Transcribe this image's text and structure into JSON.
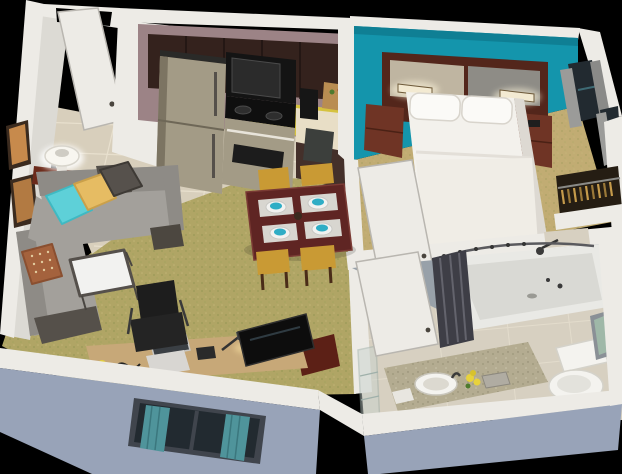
{
  "scene": {
    "title": "3D cutaway floor plan render of a studio hotel suite",
    "view": "aerial isometric cutaway on black background"
  },
  "palette": {
    "black": "#000000",
    "wallWhite": "#edebe6",
    "wallShade": "#c9c6c0",
    "wallFace": "#dcdad4",
    "extWall": "#98a3b8",
    "tile": "#d8cfbc",
    "carpet": "#b0a565",
    "bedroomCarpet": "#c1ac73",
    "bathTile": "#d7d0c1",
    "teal": "#1495ac",
    "mauve": "#9c8386",
    "cabinet": "#34221d",
    "backsplash": "#d5c23f",
    "counter": "#e8dec6",
    "stainless": "#a39b86",
    "applianceBlack": "#141414",
    "headboardWood": "#53261b",
    "headboardTan": "#bfb5a1",
    "headboardGray": "#8e8c86",
    "nightstand": "#6f3425",
    "bedWhite": "#f3f1ec",
    "sofa": "#a3a09b",
    "sofaDark": "#8e8b86",
    "pillowTeal": "#5ed0d8",
    "pillowYellow": "#e6bc63",
    "pillowGray": "#56514c",
    "pillowRust": "#a4623d",
    "consoleWood": "#6b2a1a",
    "tableWood": "#5f2523",
    "chairYellow": "#c99a34",
    "plateWhite": "#f2f2f0",
    "bowlTeal": "#2fadc5",
    "deskWood": "#c7a878",
    "chairBlack": "#1d1d1d",
    "tvBlack": "#0d0d0d",
    "tvStand": "#5c2016",
    "curtainTeal": "#4f949b",
    "glassDark": "#222a30",
    "curtainGray": "#9b9b99",
    "showerWall": "#98a1a9",
    "tubWhite": "#e9e9e5",
    "curtainDark": "#3e3e46",
    "vanityCounter": "#b4ac91",
    "porcelain": "#f4f3ef",
    "glassGreen": "#9fb8a8",
    "hangerGold": "#c59b4b",
    "closetDark": "#251d13",
    "artOrange": "#c78a4c",
    "frameDark": "#3b2b1f",
    "lampWhite": "#f8f6f0"
  },
  "rooms": {
    "entry": {
      "label": "Entry",
      "items": [
        "open entry door",
        "tile floor",
        "closet partition"
      ]
    },
    "kitchen": {
      "label": "Kitchen",
      "items": [
        "stainless refrigerator",
        "microwave",
        "range with oven",
        "dark upper cabinets",
        "yellow backsplash",
        "counter with coffee maker and bread basket",
        "trash can"
      ]
    },
    "dining": {
      "label": "Dining Area",
      "items": [
        "dark wood table",
        "four mustard chairs",
        "four place settings with teal bowls on gray placemats"
      ]
    },
    "living": {
      "label": "Living Room",
      "items": [
        "gray L-sectional sofa",
        "teal, yellow, charcoal and patterned pillows",
        "white table lamp on red-wood console",
        "two framed artworks",
        "white-top end table",
        "work desk with laptop, phone and task lamp",
        "black office chair",
        "flat-screen TV on red-wood stand",
        "exterior window with teal curtains"
      ]
    },
    "bedroom": {
      "label": "Bedroom",
      "items": [
        "teal accent wall",
        "two-tone headboard with lit sconces",
        "bed with white bedding and two pillows",
        "two dark wood nightstands",
        "telephone",
        "side window with gray curtains",
        "closet rod with hangers",
        "open door"
      ]
    },
    "bathroom": {
      "label": "Bathroom",
      "items": [
        "bathtub shower with curved rod",
        "bunched dark shower curtain",
        "shower head",
        "toilet",
        "speckled vanity counter with round sink",
        "yellow flowers",
        "amenity tray",
        "glass shelf unit",
        "small green window",
        "open door"
      ]
    }
  }
}
